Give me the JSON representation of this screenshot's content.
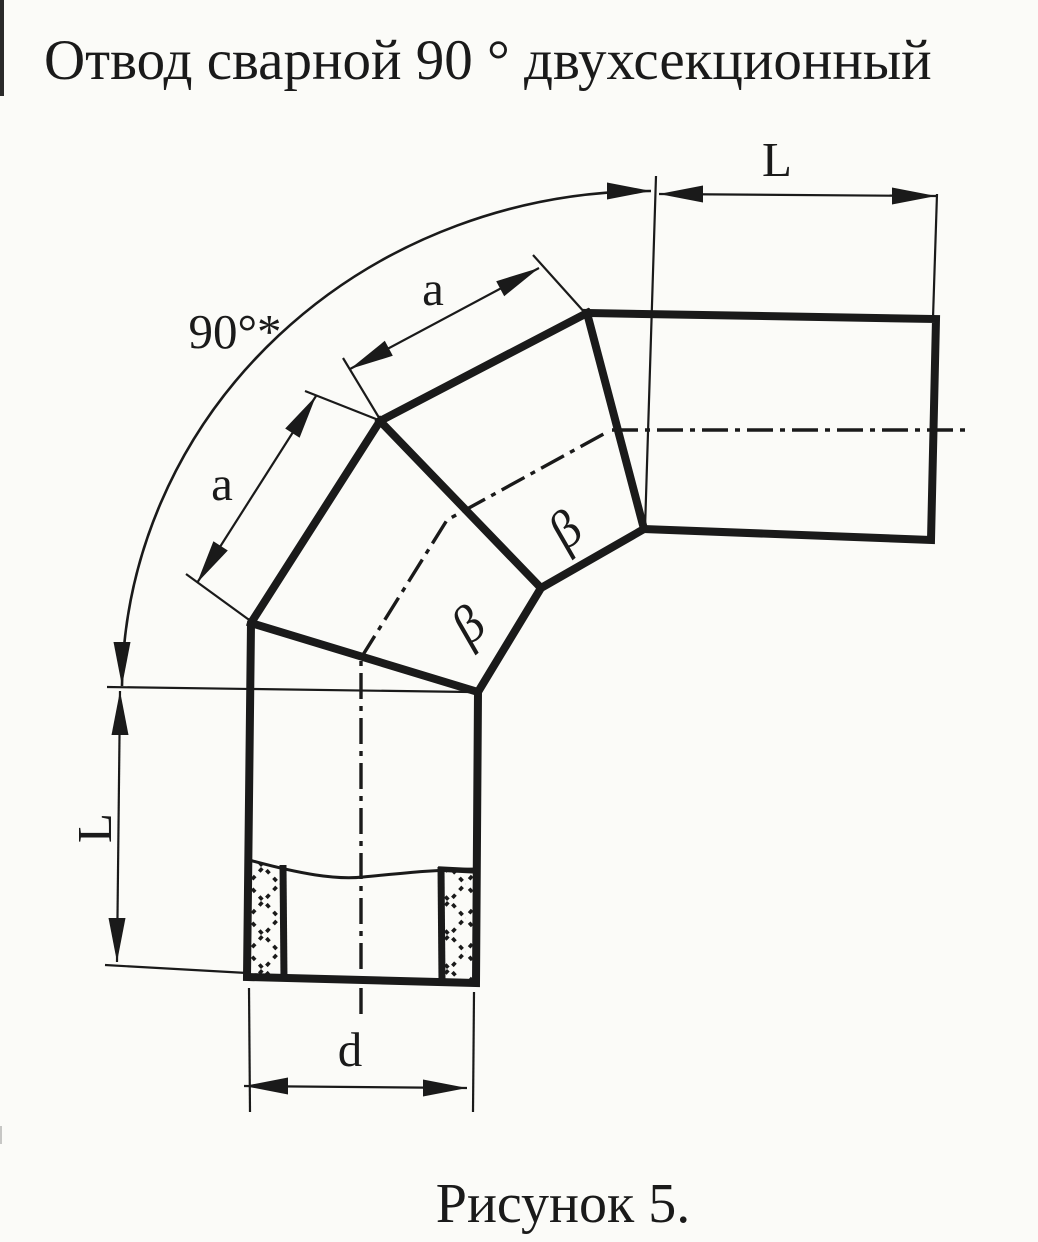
{
  "title": "Отвод сварной 90 ° двухсекционный",
  "caption": "Рисунок 5.",
  "dimensions": {
    "angle_label": "90°*",
    "top_run_length": "L",
    "left_run_length": "L",
    "upper_section_length": "a",
    "lower_section_length": "a",
    "bore_diameter": "d",
    "upper_bevel_angle": "β",
    "lower_bevel_angle": "β"
  },
  "colors": {
    "ink": "#1a1a1a",
    "paper": "#fbfbf8"
  }
}
